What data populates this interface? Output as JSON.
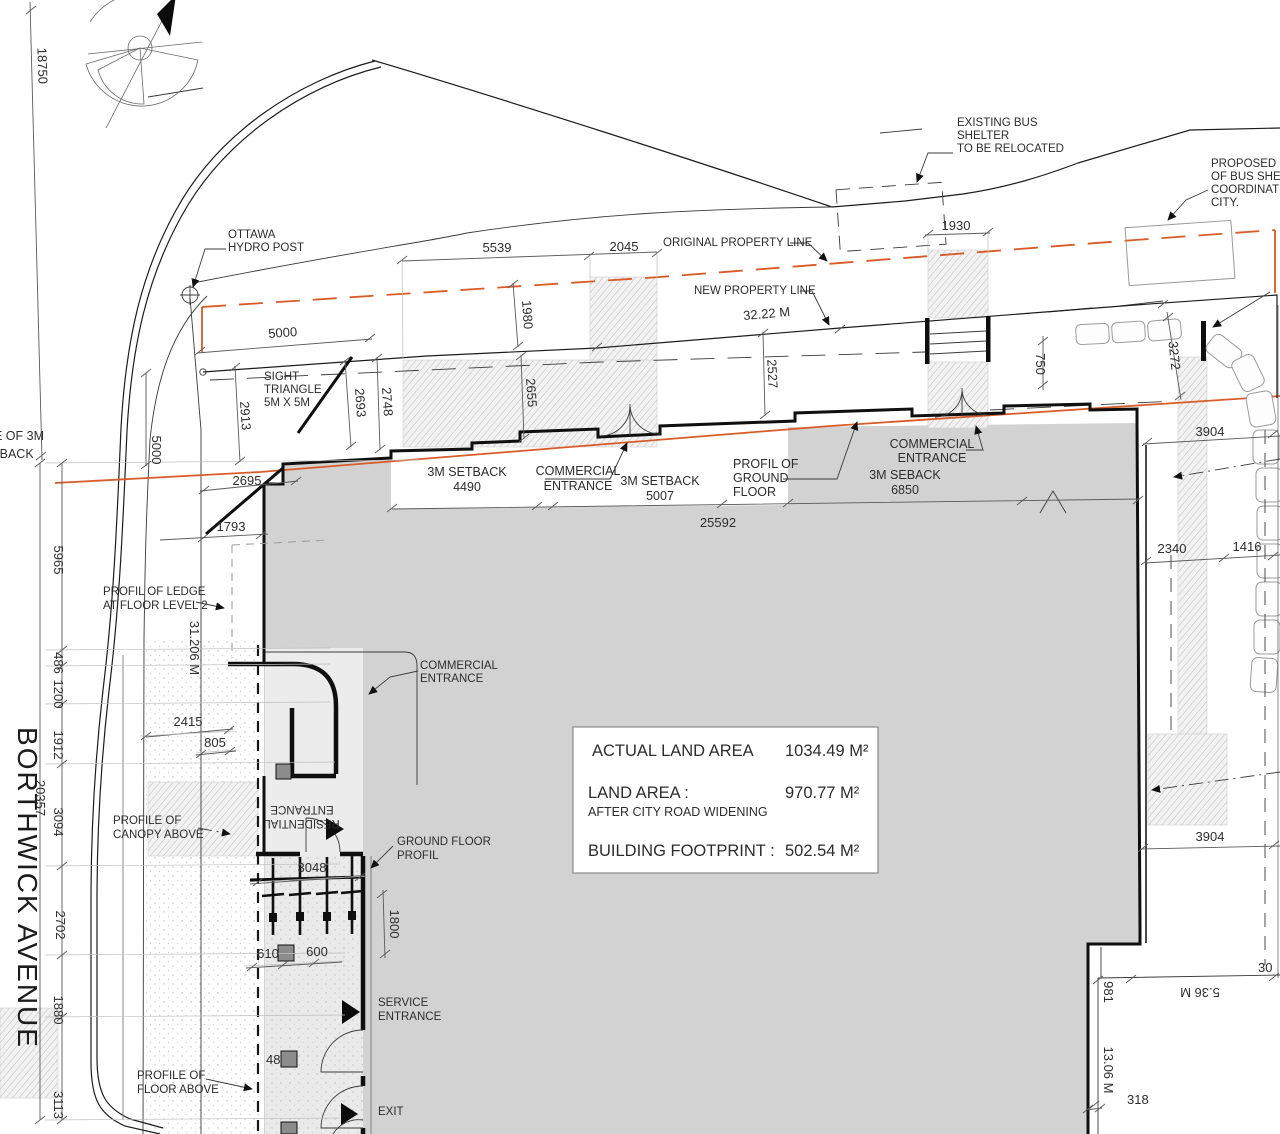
{
  "plan": {
    "street": "BORTHWICK AVENUE",
    "annotations": {
      "hydro_1": "OTTAWA",
      "hydro_2": "HYDRO POST",
      "sight_1": "SIGHT",
      "sight_2": "TRIANGLE",
      "sight_3": "5M X 5M",
      "original_pl": "ORIGINAL PROPERTY LINE",
      "new_pl": "NEW PROPERTY LINE",
      "existing_bus_1": "EXISTING BUS",
      "existing_bus_2": "SHELTER",
      "existing_bus_3": "TO BE RELOCATED",
      "proposed_bus_1": "PROPOSED LO",
      "proposed_bus_2": "OF BUS SHELT",
      "proposed_bus_3": "COORDINATED",
      "proposed_bus_4": "CITY.",
      "setback_label": "3M  SETBACK",
      "seback_label": "3M  SEBACK",
      "commercial_1": "COMMERCIAL",
      "commercial_2": "ENTRANCE",
      "profil_ground_1": "PROFIL OF",
      "profil_ground_2": "GROUND",
      "profil_ground_3": "FLOOR",
      "ledge_1": "PROFIL OF LEDGE",
      "ledge_2": "AT FLOOR LEVEL 2",
      "canopy_1": "PROFILE OF",
      "canopy_2": "CANOPY ABOVE",
      "residential_1": "RESIDENTIAL",
      "residential_2": "ENTRANCE",
      "ground_profil_1": "GROUND FLOOR",
      "ground_profil_2": "PROFIL",
      "service_1": "SERVICE",
      "service_2": "ENTRANCE",
      "exit": "EXIT",
      "floor_above_1": "PROFILE OF",
      "floor_above_2": "FLOOR ABOVE",
      "setback_edge_1": "E OF 3M",
      "setback_edge_2": "TBACK"
    },
    "dimensions": {
      "d18750": "18750",
      "d5000_top": "5000",
      "d5000_left": "5000",
      "d5539": "5539",
      "d2045": "2045",
      "d1930": "1930",
      "d1980": "1980",
      "d2655": "2655",
      "d2527": "2527",
      "d3222": "32.22  M",
      "d2913": "2913",
      "d2693": "2693",
      "d2748": "2748",
      "d2695": "2695",
      "d1793": "1793",
      "d5965": "5965",
      "d486": "486",
      "d1200": "1200",
      "d1912": "1912",
      "d20357": "20357",
      "d3094": "3094",
      "d2702": "2702",
      "d1880": "1880",
      "d3113": "3113",
      "d31206": "31.206  M",
      "d2415": "2415",
      "d805": "805",
      "d3048": "3048",
      "d1800": "1800",
      "d610": "610",
      "d600": "600",
      "d48": "48",
      "d25592": "25592",
      "d4490": "4490",
      "d5007": "5007",
      "d6850": "6850",
      "d750": "750",
      "d3272": "3272",
      "d3904_top": "3904",
      "d2340": "2340",
      "d1416": "1416",
      "d3904_bot": "3904",
      "d981": "981",
      "d536": "5.36 M",
      "d30": "30",
      "d1306": "13.06 M",
      "d318": "318"
    },
    "area_summary": {
      "row1_label": "ACTUAL LAND AREA",
      "row1_value": "1034.49 M²",
      "row2_label": "LAND AREA :",
      "row2_value": "970.77 M²",
      "row2_note": "AFTER CITY ROAD WIDENING",
      "row3_label": "BUILDING FOOTPRINT :",
      "row3_value": "502.54 M²"
    },
    "colors": {
      "property_line_orange": "#D95B27",
      "building_gray": "#D2D2D2",
      "light_gray": "#E9E9E9",
      "column_gray": "#8C8C8C"
    }
  }
}
